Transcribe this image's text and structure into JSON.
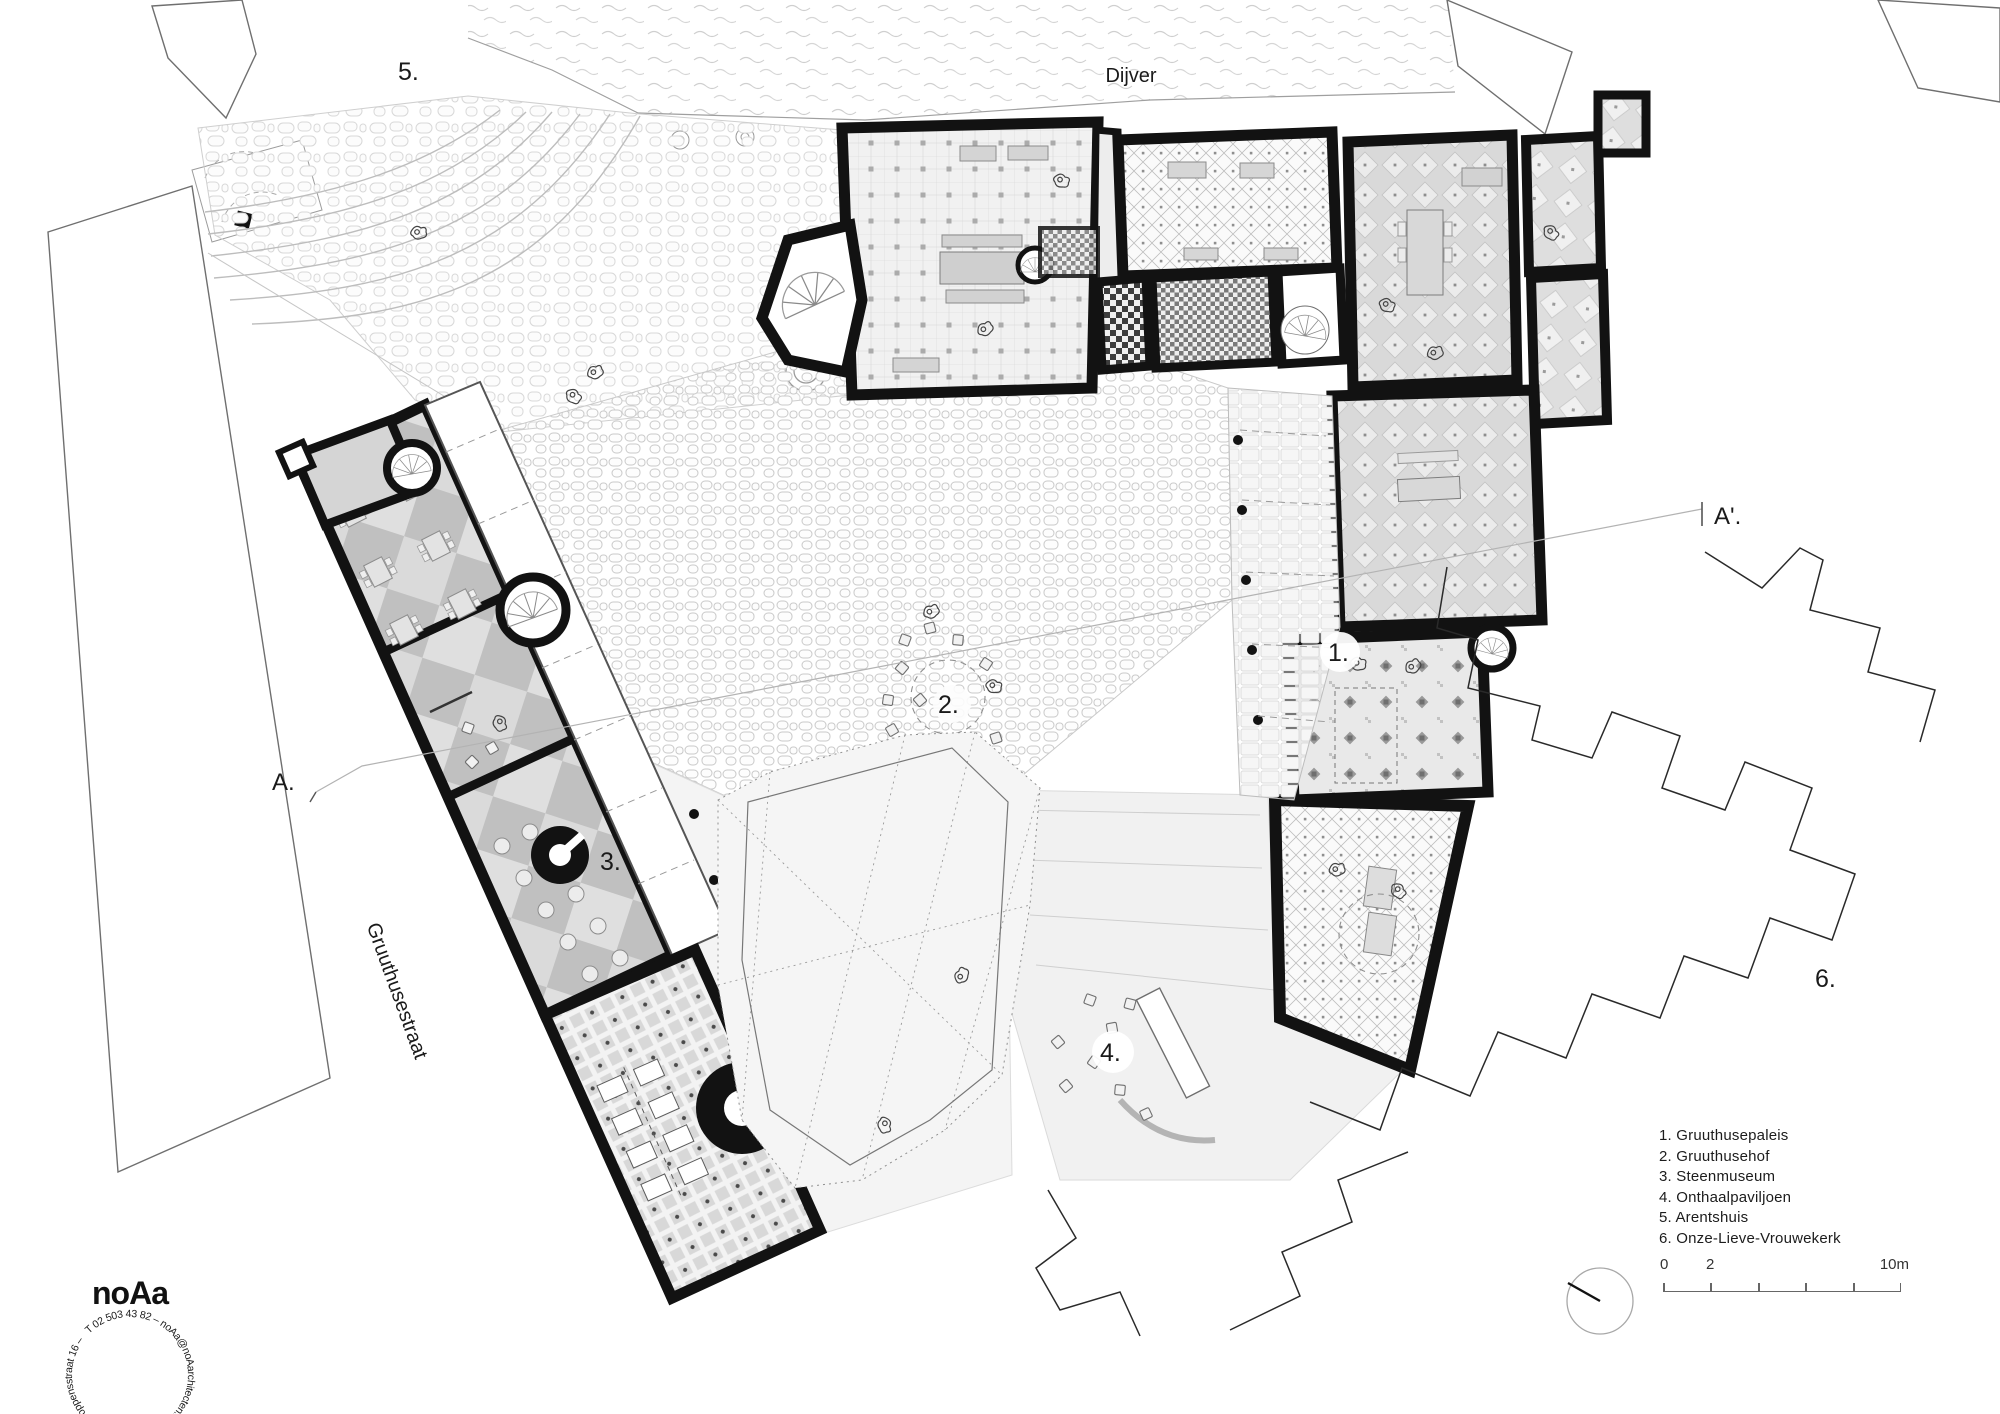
{
  "drawing": {
    "street_top": "Dijver",
    "street_left": "Gruuthusestraat",
    "section": {
      "start": "A.",
      "end": "A'."
    },
    "markers": {
      "m1": "1.",
      "m2": "2.",
      "m3": "3.",
      "m4": "4.",
      "m5": "5.",
      "m6": "6."
    }
  },
  "legend": {
    "items": [
      {
        "label": "1. Gruuthusepaleis"
      },
      {
        "label": "2. Gruuthusehof"
      },
      {
        "label": "3. Steenmuseum"
      },
      {
        "label": "4. Onthaalpaviljoen"
      },
      {
        "label": "5. Arentshuis"
      },
      {
        "label": "6. Onze-Lieve-Vrouwekerk"
      }
    ]
  },
  "scalebar": {
    "start": "0",
    "mid": "2",
    "end": "10m"
  },
  "stamp": {
    "logo": "noAa",
    "ring": "T 02 503 43 82 – noAa@noAarchitecten.net – B 1070 Brussel Foppensstraat 16 –"
  },
  "colors": {
    "wall": "#121212",
    "floor_light": "#ededed",
    "floor_mid": "#d7d7d7",
    "line_gray": "#9a9a9a"
  }
}
